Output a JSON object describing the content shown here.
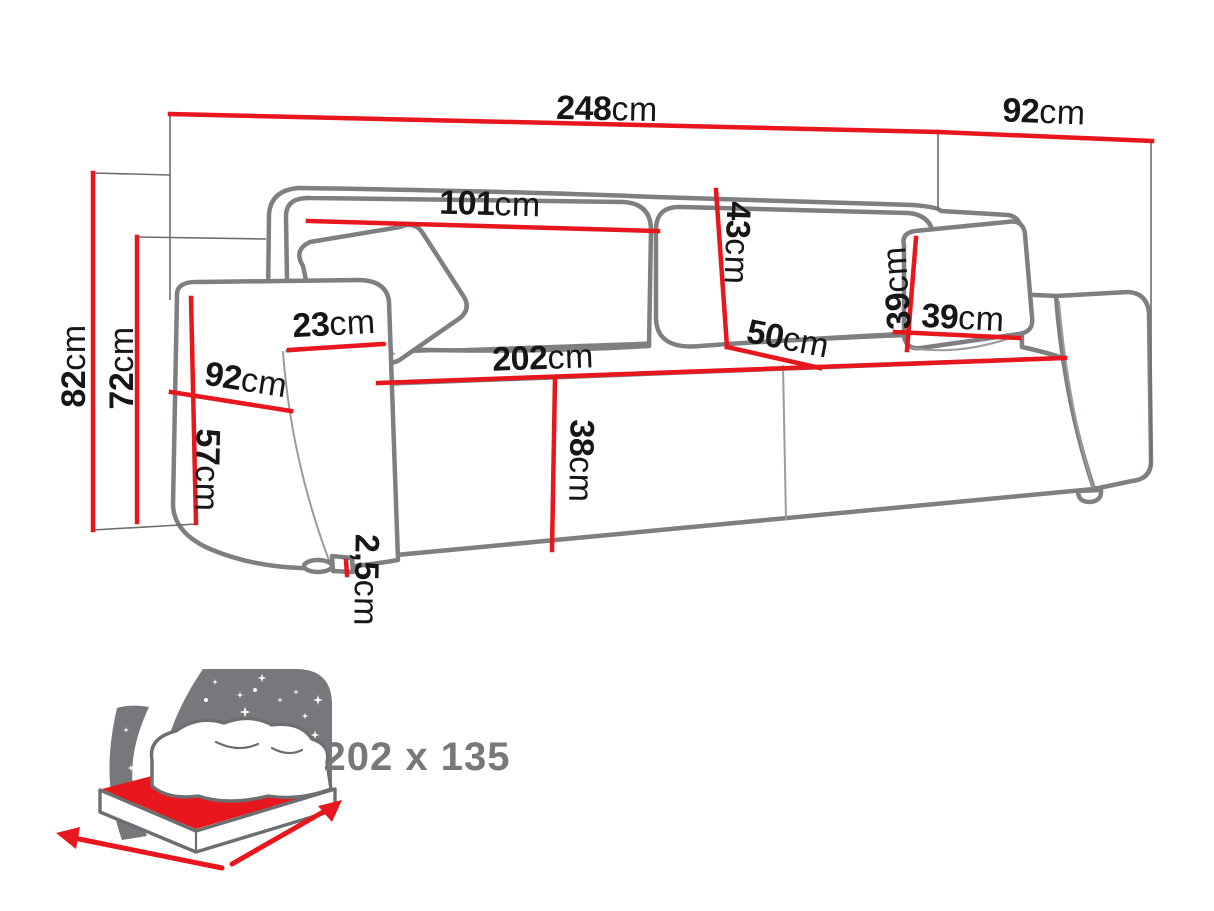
{
  "dimensions": {
    "width_total": {
      "value": "248",
      "unit": "cm"
    },
    "depth_total": {
      "value": "92",
      "unit": "cm"
    },
    "backrest_width": {
      "value": "101",
      "unit": "cm"
    },
    "backrest_height": {
      "value": "43",
      "unit": "cm"
    },
    "armrest_top_width": {
      "value": "23",
      "unit": "cm"
    },
    "armrest_depth": {
      "value": "92",
      "unit": "cm"
    },
    "seat_width": {
      "value": "202",
      "unit": "cm"
    },
    "seat_depth": {
      "value": "50",
      "unit": "cm"
    },
    "cushion_height": {
      "value": "39",
      "unit": "cm"
    },
    "cushion_width": {
      "value": "39",
      "unit": "cm"
    },
    "seat_height": {
      "value": "38",
      "unit": "cm"
    },
    "armrest_height": {
      "value": "57",
      "unit": "cm"
    },
    "height_total": {
      "value": "82",
      "unit": "cm"
    },
    "backrest_top_height": {
      "value": "72",
      "unit": "cm"
    },
    "leg_height": {
      "value": "2,5",
      "unit": "cm"
    }
  },
  "sleeping_area": {
    "label": "202 x 135"
  },
  "colors": {
    "dimension_red": "#e8161d",
    "outline_gray": "#7d7f80",
    "icon_gray": "#77787b",
    "text_black": "#161616"
  }
}
